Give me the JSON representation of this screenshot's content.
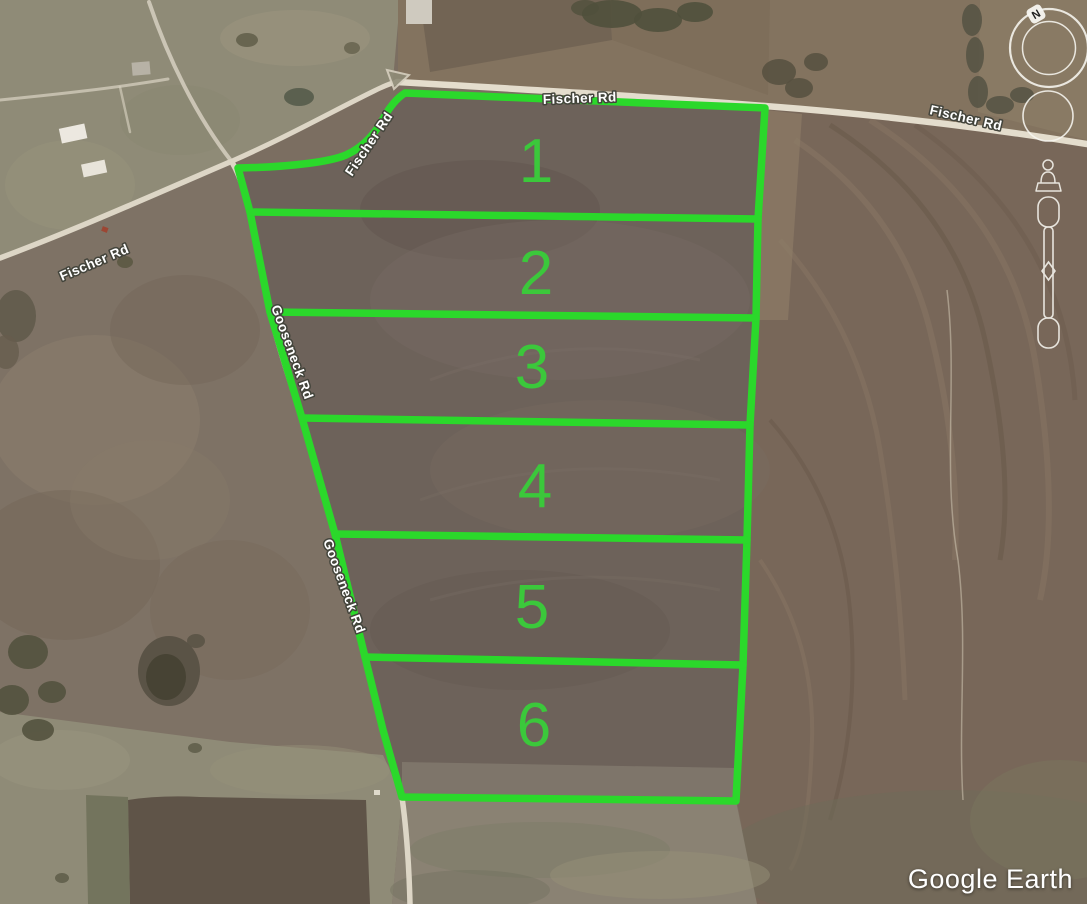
{
  "branding": {
    "watermark": "Google Earth"
  },
  "map": {
    "colors": {
      "parcel_outline": "#2bd82b",
      "lot_number": "#3bc83b",
      "road_label_fill": "#ffffff",
      "road_label_outline": "#43443b"
    },
    "road_labels": [
      {
        "id": "fischer-rd-west",
        "text": "Fischer Rd"
      },
      {
        "id": "fischer-rd-diagonal",
        "text": "Fischer Rd"
      },
      {
        "id": "fischer-rd-top",
        "text": "Fischer Rd"
      },
      {
        "id": "fischer-rd-east",
        "text": "Fischer Rd"
      },
      {
        "id": "gooseneck-rd-upper",
        "text": "Gooseneck Rd"
      },
      {
        "id": "gooseneck-rd-lower",
        "text": "Gooseneck Rd"
      }
    ],
    "lots": [
      {
        "number": "1"
      },
      {
        "number": "2"
      },
      {
        "number": "3"
      },
      {
        "number": "4"
      },
      {
        "number": "5"
      },
      {
        "number": "6"
      }
    ],
    "nav": {
      "north_label": "N"
    }
  }
}
